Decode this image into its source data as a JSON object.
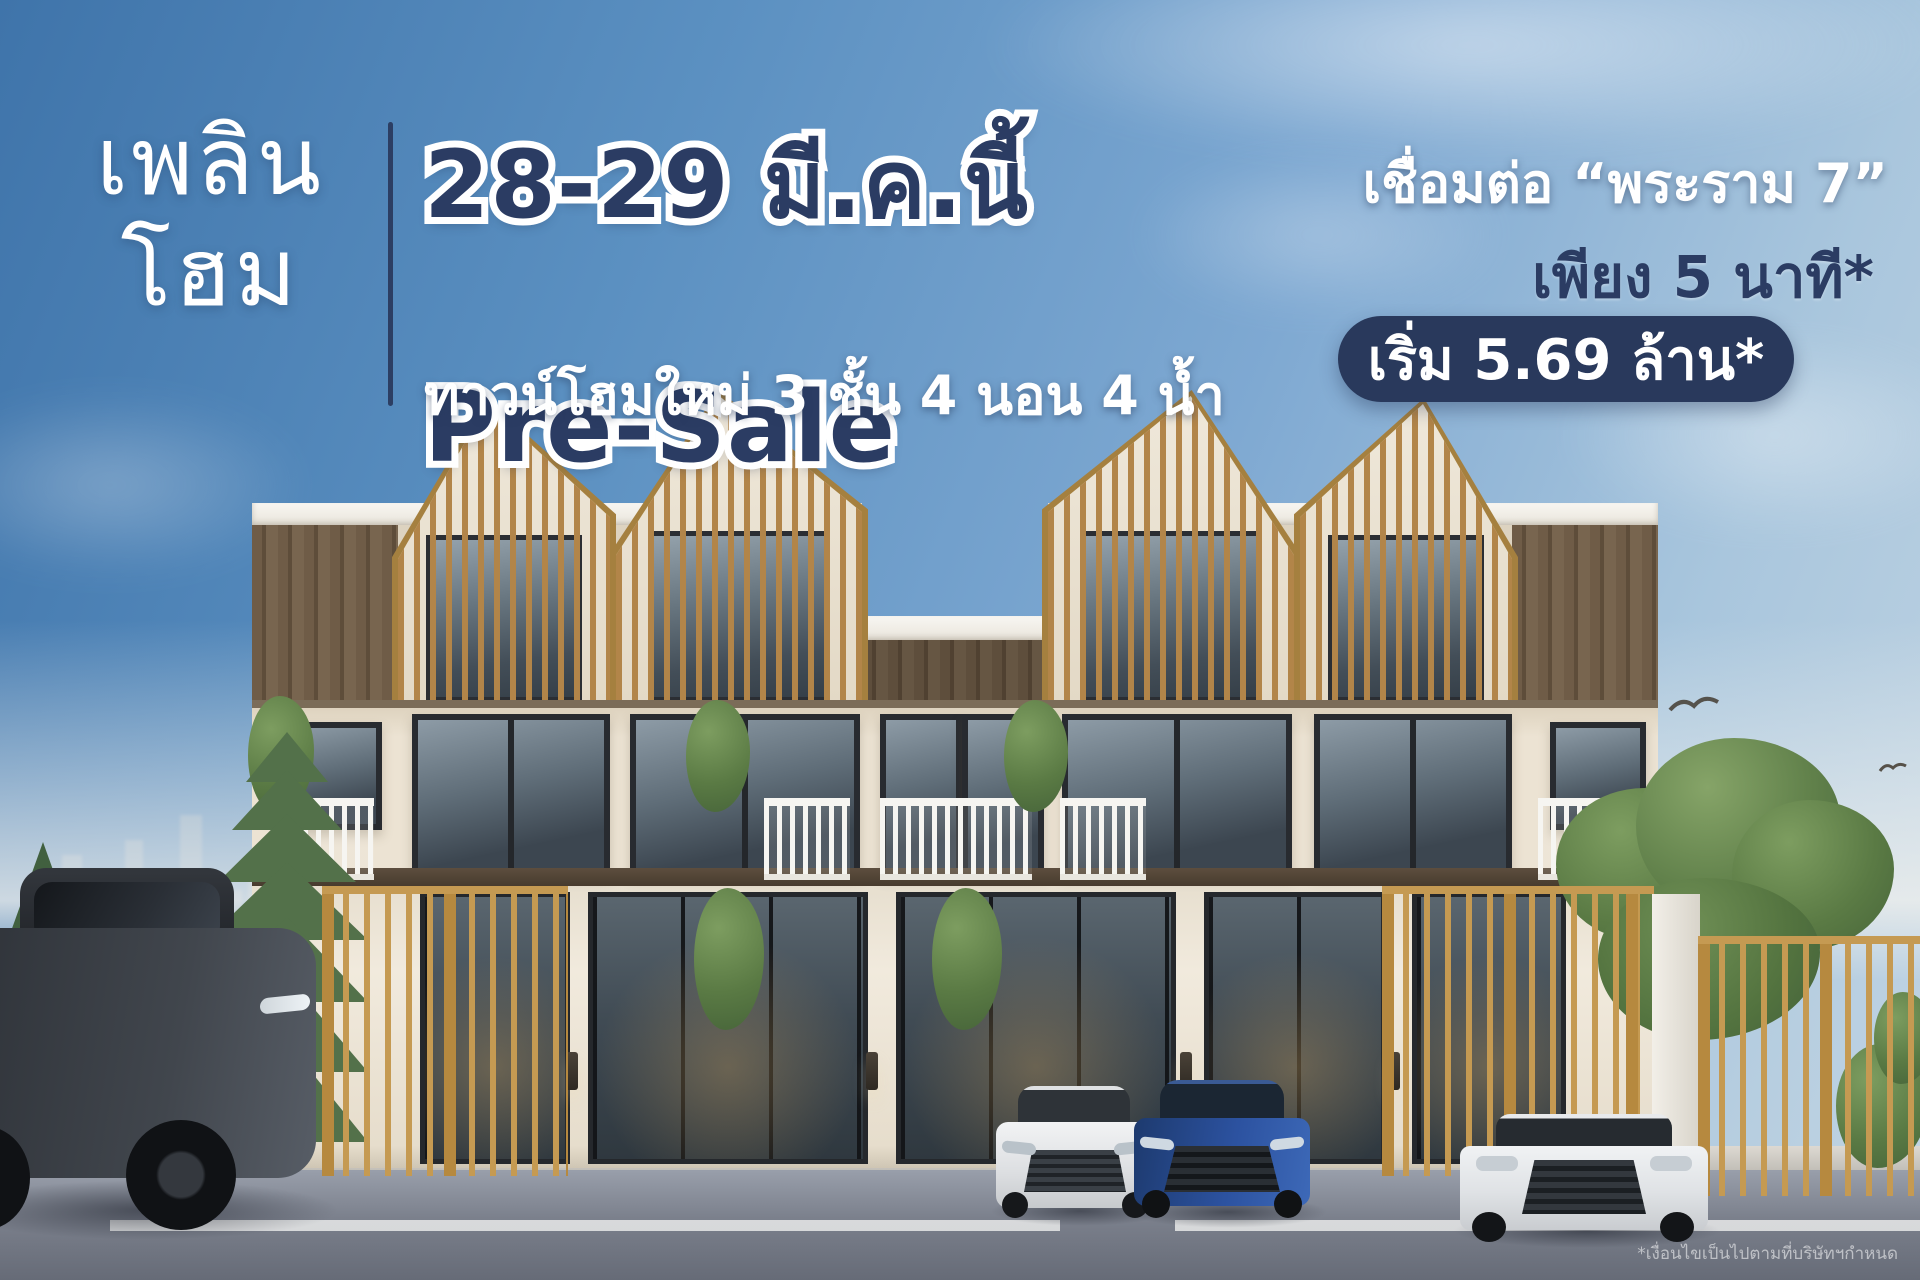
{
  "poster": {
    "logo": {
      "line1": "เพลิน",
      "line2": "โฮม"
    },
    "headline": {
      "date": "28-29 มี.ค.นี้",
      "event": "Pre-Sale",
      "subtitle": "ทาวน์โฮมใหม่ 3 ชั้น 4 นอน 4 น้ำ"
    },
    "location": {
      "connect": "เชื่อมต่อ “พระราม 7”",
      "travel_time": "เพียง 5 นาที*"
    },
    "price_badge": "เริ่ม 5.69 ล้าน*",
    "disclaimer": "*เงื่อนไขเป็นไปตามที่บริษัทฯกำหนด",
    "colors": {
      "navy": "#2b3c63",
      "badge_bg": "#29395c",
      "wood_slat": "#b28549",
      "cream_wall": "#ece4d4",
      "gold_fence": "#c59a52",
      "sky_top": "#3f74aa",
      "text_white": "#ffffff"
    }
  }
}
